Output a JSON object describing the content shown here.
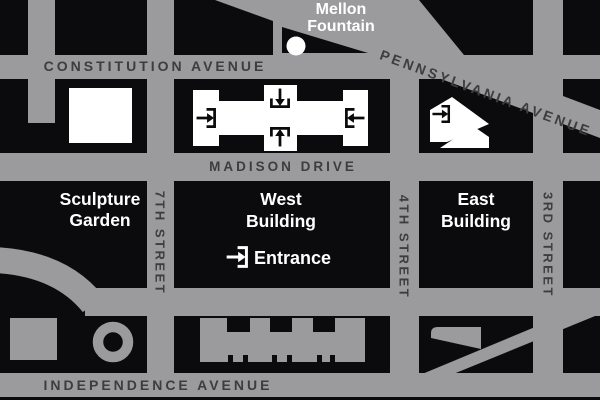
{
  "colors": {
    "street_gray": "#9b9b9d",
    "bldg_gray": "#9b9b9d",
    "block_black": "#0b0b0d",
    "text_dark": "#3d3d40",
    "white": "#ffffff"
  },
  "streets": {
    "constitution": "CONSTITUTION AVENUE",
    "pennsylvania": "PENNSYLVANIA AVENUE",
    "madison": "MADISON DRIVE",
    "independence": "INDEPENDENCE AVENUE",
    "seventh": "7TH STREET",
    "fourth": "4TH STREET",
    "third": "3RD STREET"
  },
  "places": {
    "mellon_line1": "Mellon",
    "mellon_line2": "Fountain",
    "sculpture_line1": "Sculpture",
    "sculpture_line2": "Garden",
    "west_line1": "West",
    "west_line2": "Building",
    "east_line1": "East",
    "east_line2": "Building",
    "entrance": "Entrance"
  }
}
